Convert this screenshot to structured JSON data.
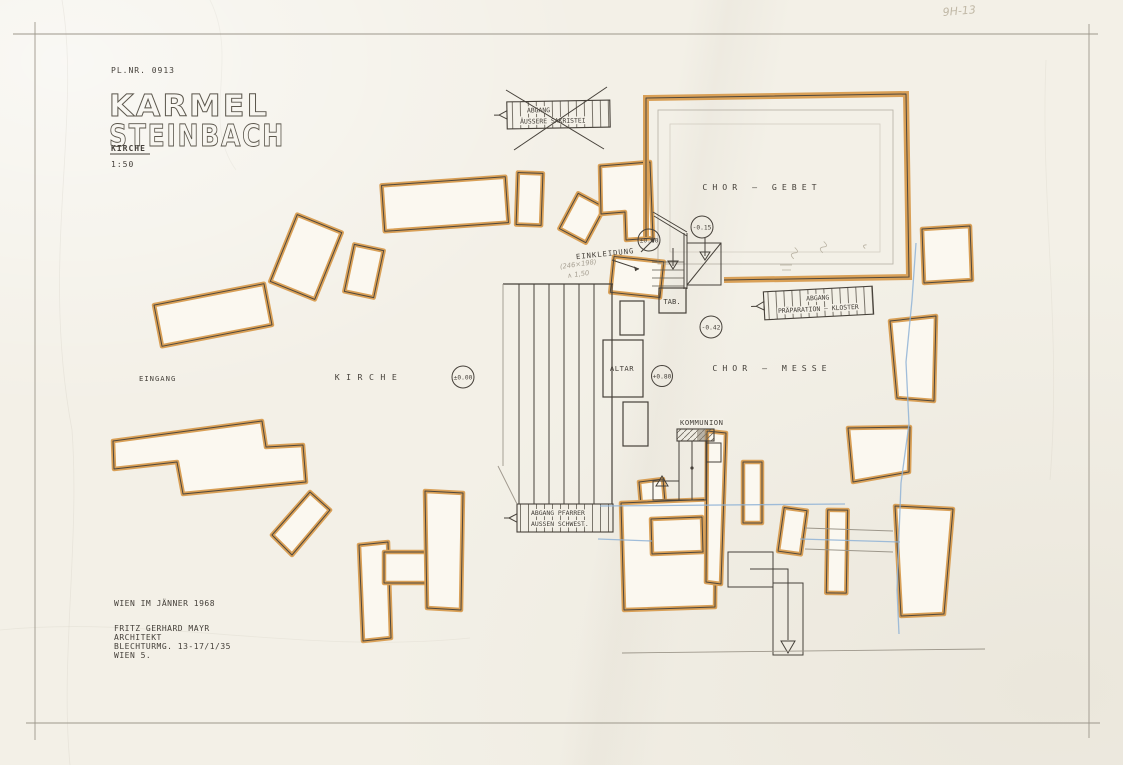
{
  "sheet": {
    "plan_number": "PL.NR. 0913",
    "title_line1": "KARMEL",
    "title_line2": "STEINBACH",
    "subtitle": "KIRCHE",
    "scale": "1:50",
    "date_note": "WIEN IM JÄNNER 1968",
    "architect_name": "FRITZ GERHARD MAYR",
    "architect_title": "ARCHITEKT",
    "architect_address": "BLECHTURMG. 13-17/1/35",
    "architect_city": "WIEN 5.",
    "corner_pencil_note": "9H-13"
  },
  "rooms": {
    "chor_gebet": "CHOR — GEBET",
    "chor_messe": "CHOR — MESSE",
    "kirche": "KIRCHE",
    "eingang": "EINGANG",
    "einkleidung": "EINKLEIDUNG",
    "kommunion": "KOMMUNION",
    "altar": "ALTAR",
    "tabernacle": "TAB."
  },
  "stair_labels": {
    "sakristei_line1": "ABGANG",
    "sakristei_line2": "ÄUSSERE SAKRISTEI",
    "praeparation_line1": "ABGANG",
    "praeparation_line2": "PRÄPARATION — KLOSTER",
    "pfarrer_line1": "ABGANG PFARRER",
    "pfarrer_line2": "AUSSEN SCHWEST."
  },
  "levels": {
    "nave": "±0.00",
    "chapel": "±0.00",
    "chor_gebet": "-0.15",
    "chor_messe": "-0.42",
    "altar": "+0.80"
  },
  "pencil_annotations": {
    "einkleidung_note_line1": "(246×198)",
    "einkleidung_note_line2": "∧ 1,50"
  },
  "colors": {
    "wall_accent": "#d9a057",
    "ink": "#46413a",
    "pencil": "#9d978b",
    "blue_pencil": "#8fb3d6",
    "paper": "#f3f0e7"
  }
}
